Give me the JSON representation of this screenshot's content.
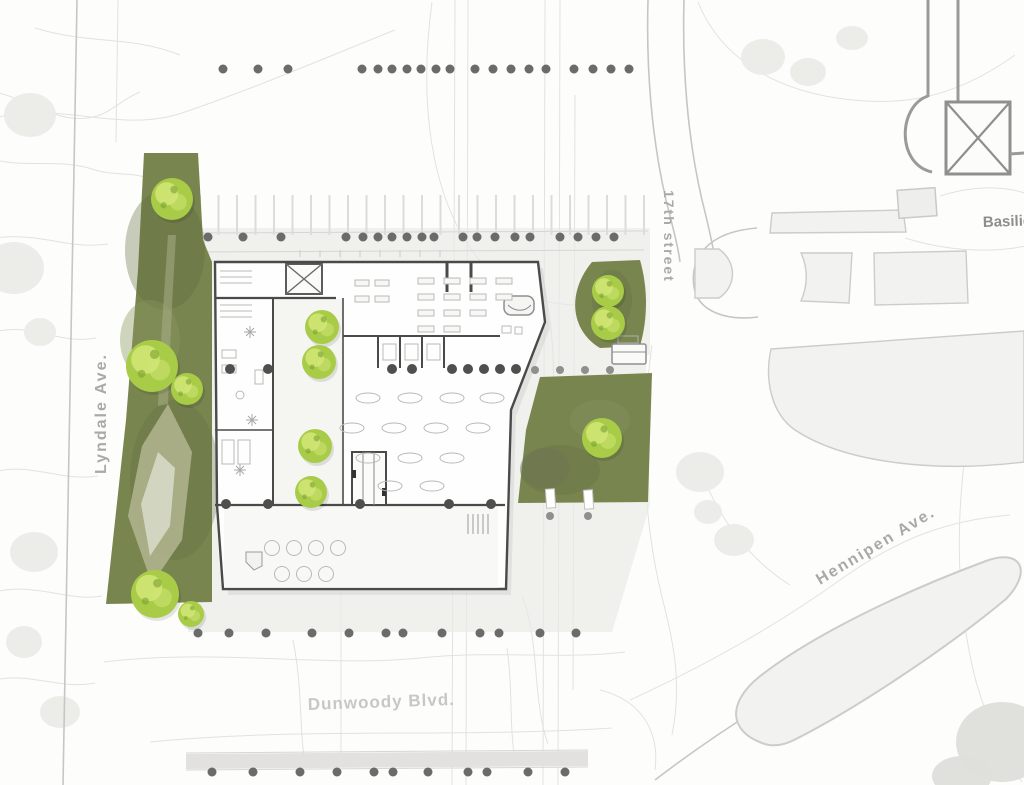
{
  "labels": {
    "lyndale": "Lyndale Ave.",
    "seventeenth_street": "17th street",
    "basilica": "Basilica",
    "hennepin": "Hennipen Ave.",
    "dunwoody": "Dunwoody Blvd."
  },
  "colors": {
    "paper": "#fcfcfb",
    "contour": "#e2e2e0",
    "road-edge": "#c6c6c4",
    "block-fill": "#f2f2f0",
    "block-stroke": "#cccccb",
    "plaza": "#eae9e7",
    "lawn": "#79854f",
    "lawn-shade": "#5f6c3e",
    "path-light": "#aeb28d",
    "path-lighter": "#d2d5c0",
    "tree-base": "#a9cc48",
    "tree-light": "#d2e678",
    "tree-dark": "#7ca031",
    "wall": "#4a4a48",
    "furniture": "#b9b9b7",
    "dot": "#6b6b69",
    "column": "#4f4f4d",
    "label": "#a9a9a7",
    "label-faint": "#c7c7c5",
    "gray-blob": "#ebebe8",
    "gray-blob-dark": "#dededb",
    "basilica-stroke": "#9a9a98"
  },
  "dot_rows": {
    "street_top": {
      "y": 69,
      "r": 4.5,
      "cls": "dot",
      "xs": [
        223,
        258,
        288,
        362,
        378,
        392,
        407,
        421,
        436,
        450,
        475,
        493,
        511,
        529,
        546,
        574,
        593,
        611,
        629
      ]
    },
    "street_upper": {
      "y": 237,
      "r": 4.5,
      "cls": "dot",
      "xs": [
        208,
        243,
        281,
        346,
        363,
        378,
        392,
        407,
        422,
        434,
        463,
        477,
        495,
        515,
        530,
        560,
        578,
        596,
        614
      ]
    },
    "street_lower": {
      "y": 633,
      "r": 4.5,
      "cls": "dot",
      "xs": [
        198,
        229,
        266,
        312,
        349,
        386,
        403,
        442,
        480,
        499,
        540,
        576
      ]
    },
    "street_bottom": {
      "y": 772,
      "r": 4.5,
      "cls": "dot",
      "xs": [
        212,
        253,
        300,
        337,
        374,
        393,
        428,
        468,
        487,
        528,
        565
      ]
    },
    "east_edge": {
      "y": 370,
      "r": 4,
      "cls": "dot-faint",
      "xs": [
        535,
        560,
        585,
        610
      ]
    },
    "crosswalk": {
      "y": 516,
      "r": 4,
      "cls": "dot-faint",
      "xs": [
        550,
        588
      ]
    },
    "columns_mid": {
      "y": 369,
      "r": 5,
      "cls": "dot-col",
      "xs": [
        230,
        268,
        392,
        412,
        452,
        468,
        484,
        500,
        516
      ]
    },
    "columns_low": {
      "y": 504,
      "r": 5,
      "cls": "dot-col",
      "xs": [
        226,
        268,
        360,
        449,
        491
      ]
    }
  },
  "trees": [
    {
      "x": 172,
      "y": 199,
      "r": 21
    },
    {
      "x": 152,
      "y": 366,
      "r": 26
    },
    {
      "x": 187,
      "y": 389,
      "r": 16
    },
    {
      "x": 155,
      "y": 594,
      "r": 24
    },
    {
      "x": 191,
      "y": 614,
      "r": 13
    },
    {
      "x": 322,
      "y": 327,
      "r": 17
    },
    {
      "x": 319,
      "y": 362,
      "r": 17
    },
    {
      "x": 315,
      "y": 446,
      "r": 17
    },
    {
      "x": 311,
      "y": 492,
      "r": 16
    },
    {
      "x": 608,
      "y": 291,
      "r": 16
    },
    {
      "x": 608,
      "y": 323,
      "r": 17
    },
    {
      "x": 602,
      "y": 438,
      "r": 20
    }
  ],
  "gray_blobs": [
    {
      "x": 30,
      "y": 115,
      "rx": 26,
      "ry": 22
    },
    {
      "x": 14,
      "y": 268,
      "rx": 30,
      "ry": 26
    },
    {
      "x": 40,
      "y": 332,
      "rx": 16,
      "ry": 14
    },
    {
      "x": 34,
      "y": 552,
      "rx": 24,
      "ry": 20
    },
    {
      "x": 24,
      "y": 642,
      "rx": 18,
      "ry": 16
    },
    {
      "x": 60,
      "y": 712,
      "rx": 20,
      "ry": 16
    },
    {
      "x": 763,
      "y": 57,
      "rx": 22,
      "ry": 18
    },
    {
      "x": 808,
      "y": 72,
      "rx": 18,
      "ry": 14
    },
    {
      "x": 852,
      "y": 38,
      "rx": 16,
      "ry": 12
    },
    {
      "x": 700,
      "y": 472,
      "rx": 24,
      "ry": 20
    },
    {
      "x": 734,
      "y": 540,
      "rx": 20,
      "ry": 16
    },
    {
      "x": 708,
      "y": 512,
      "rx": 14,
      "ry": 12
    },
    {
      "x": 1002,
      "y": 742,
      "rx": 46,
      "ry": 40,
      "dark": true
    },
    {
      "x": 962,
      "y": 776,
      "rx": 30,
      "ry": 20,
      "dark": true
    }
  ],
  "parking": {
    "x0": 200,
    "dx": 18.5,
    "n": 25,
    "y1": 195,
    "y2": 235
  }
}
